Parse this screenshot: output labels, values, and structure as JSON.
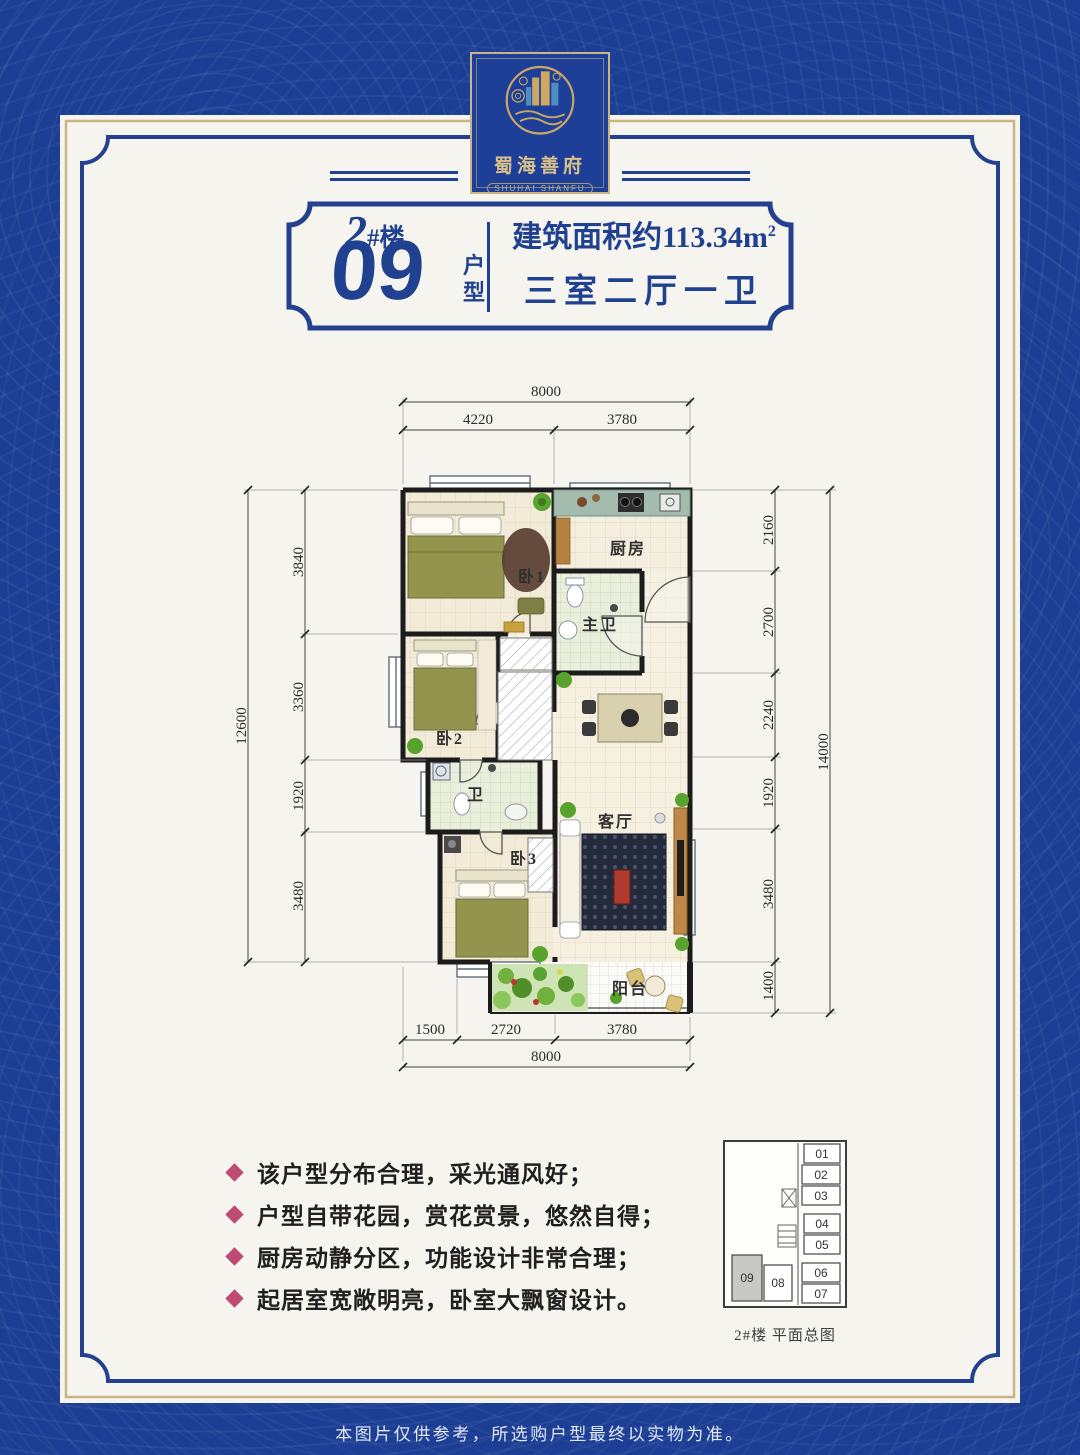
{
  "colors": {
    "background_blue": "#1c3e94",
    "accent_blue": "#20418f",
    "gold": "#c9b585",
    "bullet_pink": "#bf4a73",
    "highlight_unit_gray": "#c8c8c6"
  },
  "logo": {
    "name_cn": "蜀海善府",
    "name_en": "SHUHAI SHANFU"
  },
  "header": {
    "building_num": "2",
    "building_suffix": "#楼",
    "unit_number": "09",
    "unit_label": "户型",
    "area_text": "建筑面积约113.34m",
    "area_sup": "2",
    "layout": "三室二厅一卫"
  },
  "plan": {
    "rooms": {
      "bed1": "卧1",
      "kitchen": "厨房",
      "master_bath": "主卫",
      "bed2": "卧2",
      "bath": "卫",
      "bed3": "卧3",
      "living": "客厅",
      "balcony": "阳台"
    },
    "dims": {
      "top_total": "8000",
      "top": [
        "4220",
        "3780"
      ],
      "left_total": "12600",
      "left": [
        "3840",
        "3360",
        "1920",
        "3480"
      ],
      "right": [
        "2160",
        "2700",
        "2240",
        "1920",
        "3480",
        "1400"
      ],
      "right_total": "14000",
      "bottom": [
        "1500",
        "2720",
        "3780"
      ],
      "bottom_total": "8000"
    }
  },
  "features": [
    "该户型分布合理，采光通风好；",
    "户型自带花园，赏花赏景，悠然自得；",
    "厨房动静分区，功能设计非常合理；",
    "起居室宽敞明亮，卧室大飘窗设计。"
  ],
  "mini": {
    "units": [
      "01",
      "02",
      "03",
      "04",
      "05",
      "06",
      "07",
      "08",
      "09"
    ],
    "caption": "2#楼 平面总图",
    "highlighted": "09"
  },
  "footer": {
    "disclaimer": "本图片仅供参考，所选购户型最终以实物为准。"
  }
}
